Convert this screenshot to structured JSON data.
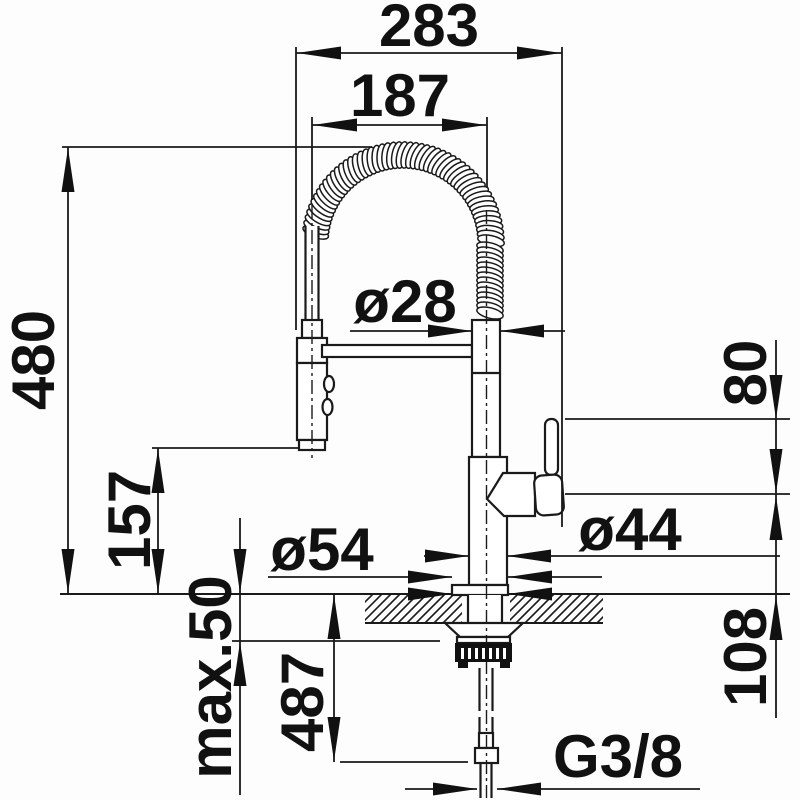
{
  "drawing": {
    "title": "faucet-installation-drawing",
    "ink_color": "#1a1a1a",
    "labels": {
      "width_total": "283",
      "spout_reach": "187",
      "spring_diameter": "ø28",
      "height_above_counter": "480",
      "spray_head_clearance": "157",
      "max_counter_thickness": "max.50",
      "hose_below_counter": "487",
      "lever_height": "80",
      "base_height": "108",
      "body_diameter": "ø44",
      "base_diameter": "ø54",
      "thread_size": "G3/8"
    }
  }
}
